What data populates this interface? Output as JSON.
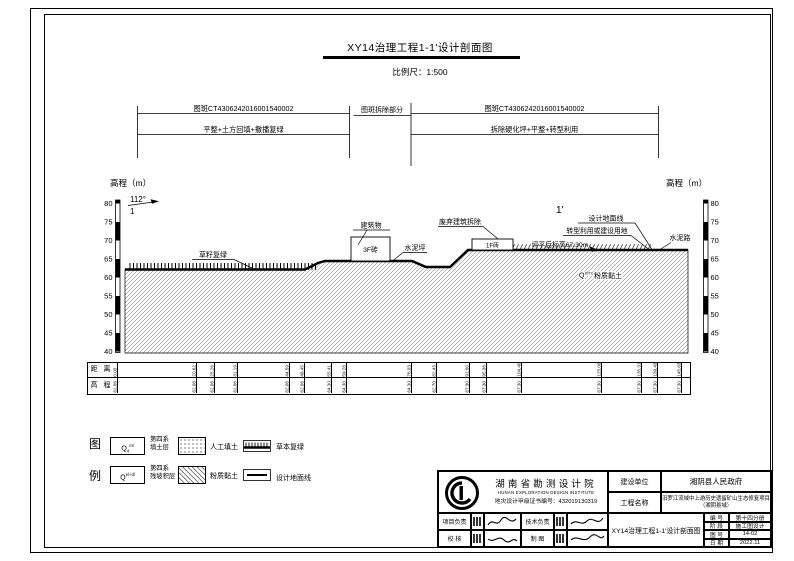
{
  "sheet": {
    "title": "XY14治理工程1-1'设计剖面图",
    "scale": "比例尺：1:500"
  },
  "dims": {
    "plot_left": "图斑CT4306242016001540002",
    "work_left": "平整+土方回填+撒播复绿",
    "mid": "图斑拆除部分",
    "plot_right": "图斑CT4306242016001540002",
    "work_right": "拆除硬化坪+平整+转型利用"
  },
  "axes": {
    "title_left": "高程（m）",
    "title_right": "高程（m）",
    "ticks": [
      "80",
      "75",
      "70",
      "65",
      "60",
      "55",
      "50",
      "45",
      "40"
    ],
    "section_start_angle": "112°",
    "section_start_num": "1",
    "section_end": "1'"
  },
  "profile": {
    "grass": "草籽复绿",
    "building": "建筑物",
    "b3f": "3F砖",
    "cement_pad": "水泥坪",
    "demolish": "废弃建筑拆除",
    "b1f": "1F砖",
    "design_line": "设计地面线",
    "reuse": "转型利用或建设用地",
    "level": "坪平后标高67.30m",
    "road": "水泥路",
    "soil_base": "Q",
    "soil_sup": "el+dl",
    "soil": "粉质黏土"
  },
  "profile_table": {
    "row_distance": "距 离",
    "row_elevation": "高 程",
    "columns": [
      {
        "d": "0.00",
        "e": "62.06"
      },
      {
        "d": "20.62",
        "e": "62.06"
      },
      {
        "d": "25.26",
        "e": "62.06"
      },
      {
        "d": "31.19",
        "e": "62.06"
      },
      {
        "d": "44.59",
        "e": "62.06"
      },
      {
        "d": "48.45",
        "e": "62.06"
      },
      {
        "d": "55.41",
        "e": "64.30"
      },
      {
        "d": "59.28",
        "e": "64.30"
      },
      {
        "d": "76.03",
        "e": "64.30"
      },
      {
        "d": "82.43",
        "e": "62.70"
      },
      {
        "d": "91.00",
        "e": "67.30"
      },
      {
        "d": "95.38",
        "e": "67.30"
      },
      {
        "d": "104.40",
        "e": "67.30"
      },
      {
        "d": "125.00",
        "e": "67.30"
      },
      {
        "d": "135.31",
        "e": "67.30"
      },
      {
        "d": "139.43",
        "e": "67.30"
      },
      {
        "d": "145.63",
        "e": "67.30"
      }
    ]
  },
  "legend": {
    "char1": "图",
    "char2": "例",
    "items": [
      {
        "code_base": "Q",
        "code_sub": "4",
        "code_sup": "ml",
        "l1": "第四系",
        "l2": "填土层"
      },
      {
        "code_base": "Q",
        "code_sub": "",
        "code_sup": "el+dl",
        "l1": "第四系",
        "l2": "残坡积层"
      },
      {
        "label": "人工填土"
      },
      {
        "label": "粉质黏土"
      },
      {
        "label": "草本复绿"
      },
      {
        "label": "设计地面线"
      }
    ]
  },
  "titleblock": {
    "institute_cn": "湖南省勘测设计院",
    "institute_en": "HUNAN EXPLORATION DESIGN INSTITUTE",
    "cert": "地灾设计甲级证书编号：432019130319",
    "role_pm": "项目负责",
    "role_tech": "技术负责",
    "role_check": "校 核",
    "role_draft": "制 图",
    "owner_label": "建设单位",
    "owner": "湘阴县人民政府",
    "project_label": "工程名称",
    "project_line1": "汨罗江流域中上游历史遗留矿山生态修复项目",
    "project_line2": "（湘阴县域）",
    "drawing_name": "XY14治理工程1-1'设计剖面图",
    "fields": [
      {
        "label": "编 号",
        "value": "第十四分册"
      },
      {
        "label": "阶 段",
        "value": "施工图设计"
      },
      {
        "label": "图 号",
        "value": "14-02"
      },
      {
        "label": "日 期",
        "value": "2022.11"
      }
    ]
  }
}
